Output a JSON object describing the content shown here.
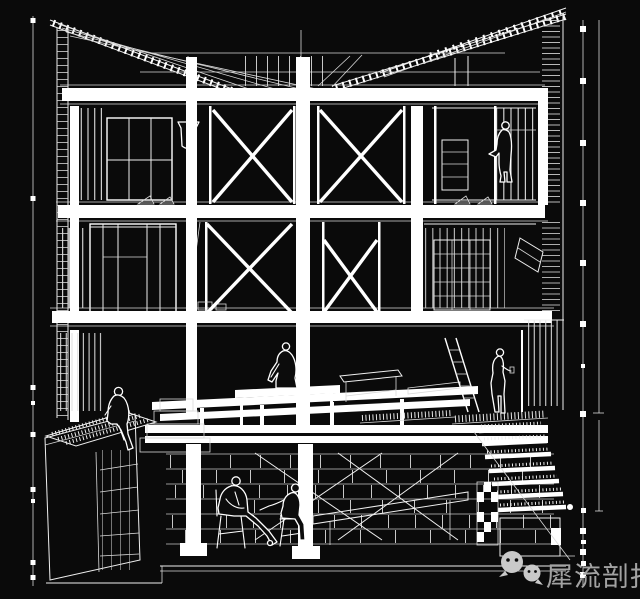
{
  "canvas": {
    "width": 640,
    "height": 599,
    "background": "#0a0a0a",
    "line_color": "#ffffff",
    "dim_tick_color": "#e8e8e8"
  },
  "drawing": {
    "kind": "architectural cutaway section perspective, white wireframe on black",
    "storeys": [
      "mono-pitch roof planes with battened rafters and clerestory",
      "upper storey with two cross-braced bays, window mullions and shelf unit",
      "middle storey with cross-braced bays, shelving rack and duct chute",
      "terrace level with deck platforms, planter box, ladder and slatted screen",
      "basement with masonry piers, cable cross-bracing, chairs and staircase"
    ],
    "figure_count": 6,
    "figures": [
      "standing man at upper shelf",
      "person seated on platform hugging knees",
      "girl seated on planter edge with legs dangling",
      "woman standing at stair landing",
      "suited man seated on a chair",
      "man seated on a chair facing him"
    ]
  },
  "dimension_scales": {
    "left_tick_count": 9,
    "right_tick_count": 14
  },
  "watermark": {
    "text": "犀流剖报",
    "text_color": "#a2a2a2",
    "icon": "wechat-chat-bubbles-icon",
    "icon_color": "#c9c9c9"
  }
}
